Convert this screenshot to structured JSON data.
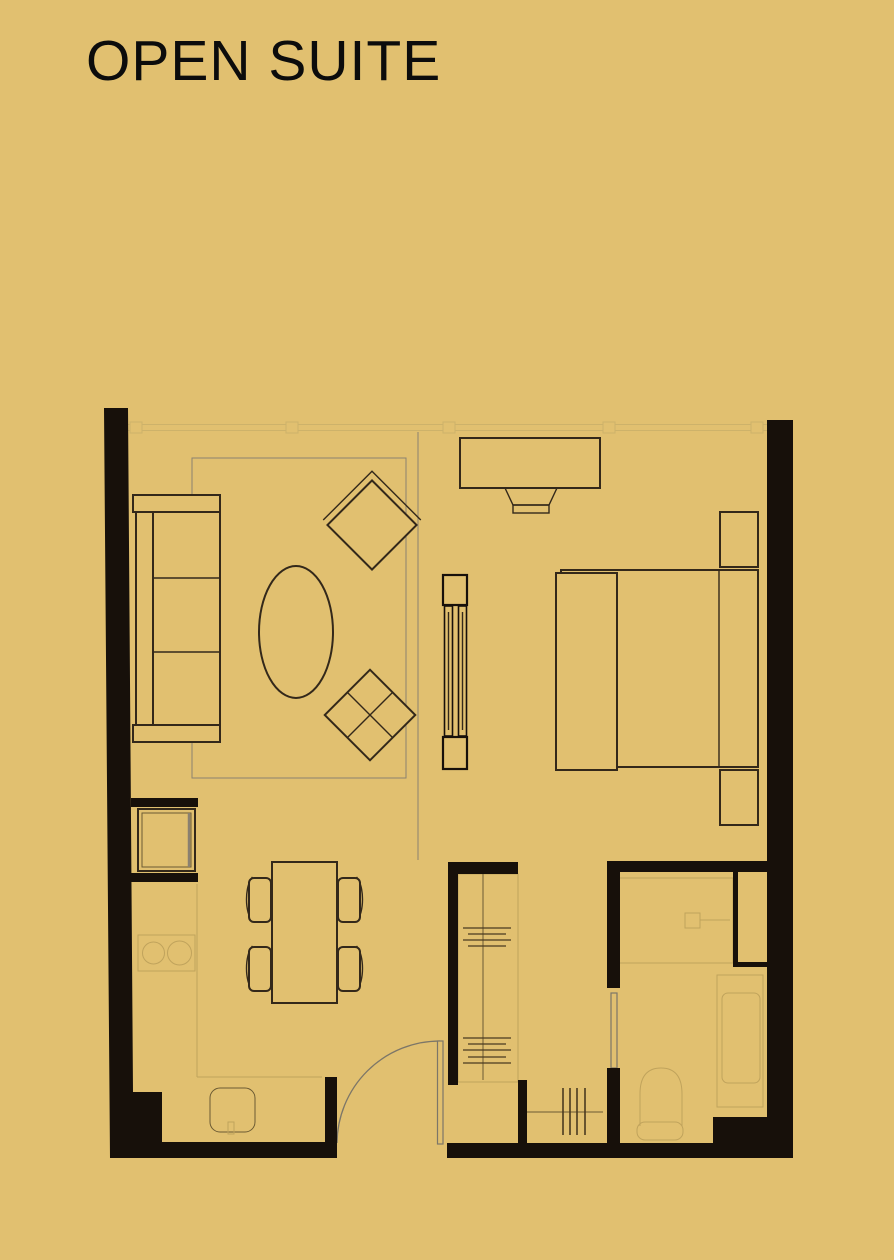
{
  "page": {
    "title": "OPEN SUITE"
  },
  "colors": {
    "bg": "#e1c070",
    "ink": "#0c0c0c",
    "wall": "#17100a",
    "furn": "#33281a",
    "faint": "#c0a35c",
    "faintdark": "#6b5a33",
    "rug": "#8b8270",
    "glass": "#cdb26a",
    "door": "#7c7668",
    "hash": "#4a3a20"
  },
  "floor_plan": {
    "unit_name": "OPEN SUITE",
    "rooms": [
      "living-area",
      "bedroom",
      "dining-area",
      "kitchen",
      "entry",
      "walk-in-closet",
      "bathroom"
    ],
    "fixtures": [
      "window-wall",
      "sofa",
      "area-rug",
      "coffee-table",
      "lounge-chair",
      "ottoman-side-table",
      "tv-console",
      "tv",
      "room-divider",
      "bed",
      "headboard",
      "nightstand",
      "nightstand",
      "dining-table",
      "dining-chair",
      "dining-chair",
      "dining-chair",
      "dining-chair",
      "refrigerator",
      "cooktop",
      "kitchen-counter",
      "kitchen-sink",
      "entry-door",
      "wardrobe",
      "shoe-rack",
      "pocket-door",
      "shower",
      "shower-head",
      "bathtub",
      "toilet"
    ]
  }
}
